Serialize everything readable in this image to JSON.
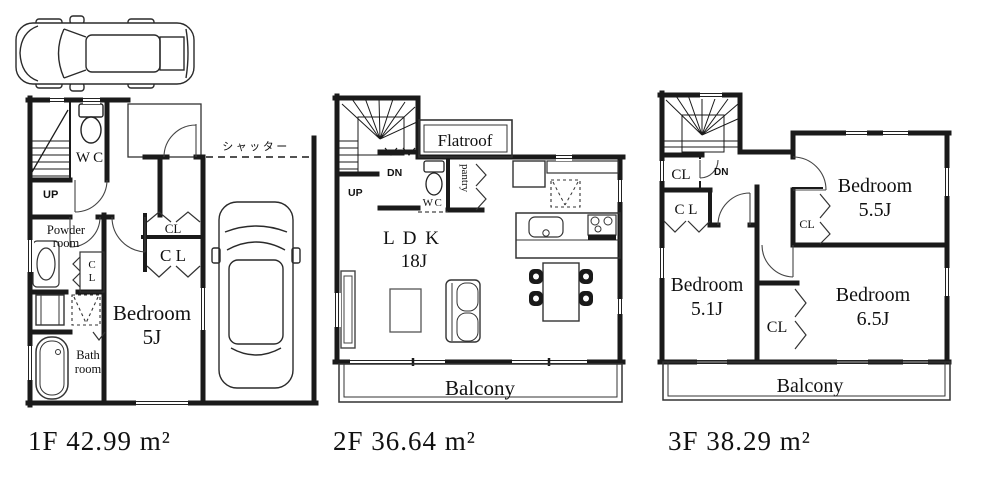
{
  "floors": [
    {
      "id": "1F",
      "area_label": "1F 42.99 m²",
      "labels": {
        "up": "UP",
        "wc": "WC",
        "powder_line1": "Powder",
        "powder_line2": "room",
        "mini_cl_c": "C",
        "mini_cl_l": "L",
        "cl_upper": "CL",
        "cl_lower": "C L",
        "bedroom": "Bedroom",
        "bedroom_size": "5J",
        "bath_line1": "Bath",
        "bath_line2": "room",
        "shutter": "シャッター"
      }
    },
    {
      "id": "2F",
      "area_label": "2F 36.64 m²",
      "labels": {
        "up": "UP",
        "dn": "DN",
        "flatroof": "Flatroof",
        "wc": "WC",
        "pantry": "pantry",
        "ldk": "L D K",
        "ldk_size": "18J",
        "balcony": "Balcony"
      }
    },
    {
      "id": "3F",
      "area_label": "3F 38.29 m²",
      "labels": {
        "dn": "DN",
        "hall_cl": "CL",
        "hall_cl2": "C L",
        "bedroom1": "Bedroom",
        "bedroom1_size": "5.5J",
        "bedroom1_cl": "CL",
        "bedroom2": "Bedroom",
        "bedroom2_size": "5.1J",
        "bedroom3": "Bedroom",
        "bedroom3_size": "6.5J",
        "mid_cl": "CL",
        "balcony": "Balcony"
      }
    }
  ],
  "colors": {
    "wall": "#1a1a1a",
    "line": "#333333",
    "up_1f_text": "#5b6d9e",
    "updn_2f_text": "#c08840",
    "dn_3f_text": "#6b5744"
  }
}
